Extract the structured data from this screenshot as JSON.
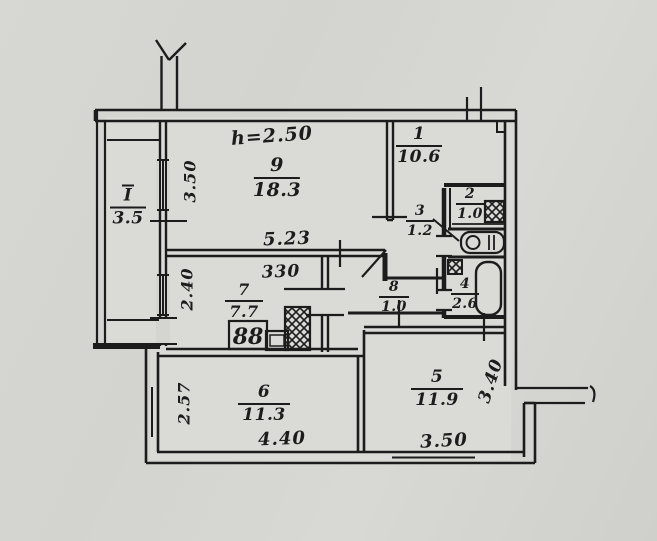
{
  "title": "apartment-floor-plan",
  "rooms": {
    "balcony": {
      "number": "I",
      "area": "3.5"
    },
    "r1": {
      "number": "1",
      "area": "10.6"
    },
    "r2": {
      "number": "2",
      "area": "1.0"
    },
    "r3": {
      "number": "3",
      "area": "1.2"
    },
    "r4": {
      "number": "4",
      "area": "2.6"
    },
    "r5": {
      "number": "5",
      "area": "11.9"
    },
    "r6": {
      "number": "6",
      "area": "11.3"
    },
    "r7": {
      "number": "7",
      "area": "7.7"
    },
    "r8": {
      "number": "8",
      "area": "1.0"
    },
    "r9": {
      "number": "9",
      "area": "18.3"
    }
  },
  "dimensions": {
    "ceiling_height": "h=2.50",
    "room9_width": "5.23",
    "room9_depth": "3.50",
    "corridor_width": "330",
    "kitchen_depth": "2.40",
    "room6_depth": "2.57",
    "room6_width": "4.40",
    "room5_width": "3.50",
    "room5_depth": "3.40"
  },
  "fixtures": {
    "stove_label": "88"
  },
  "colors": {
    "ink": "#1c1c1c",
    "paper": "#d4d4d0"
  }
}
